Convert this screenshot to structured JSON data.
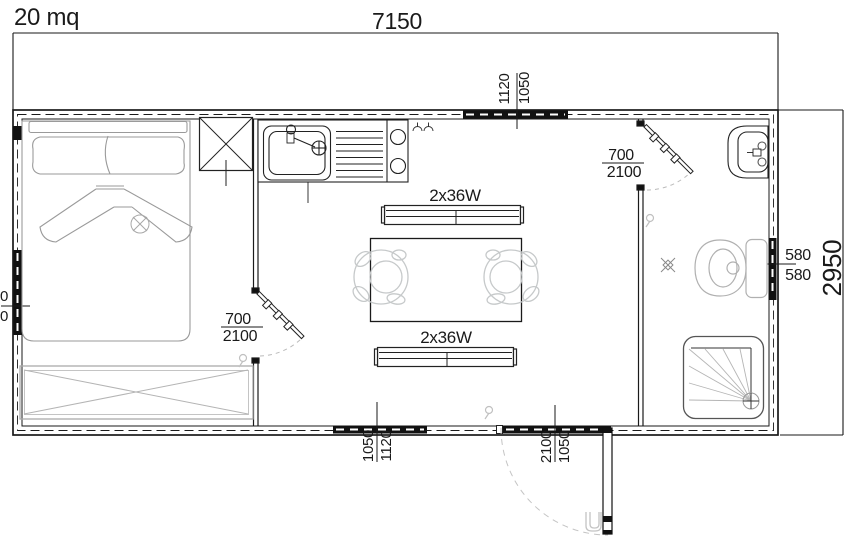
{
  "title": "20 mq",
  "dimensions": {
    "overall_width": "7150",
    "overall_height": "2950"
  },
  "labels": {
    "top_window": {
      "left": "1120",
      "right": "1050"
    },
    "left_window": {
      "top": "0",
      "bottom": "0"
    },
    "bedroom_door": {
      "top": "700",
      "bottom": "2100"
    },
    "bathroom_door": {
      "top": "700",
      "bottom": "2100"
    },
    "right_window": {
      "top": "580",
      "bottom": "580"
    },
    "bottom_window": {
      "left": "1050",
      "right": "1120"
    },
    "entrance_door": {
      "left": "2100",
      "right": "1050"
    }
  },
  "lights": {
    "fixture_top": "2x36W",
    "fixture_bottom": "2x36W"
  },
  "colors": {
    "wall": "#1a1a1a",
    "fixture_line": "#222222",
    "furniture_gray": "#9a9a9a",
    "light_gray": "#c2c5c7",
    "window_fill": "#111111",
    "background": "#ffffff"
  }
}
